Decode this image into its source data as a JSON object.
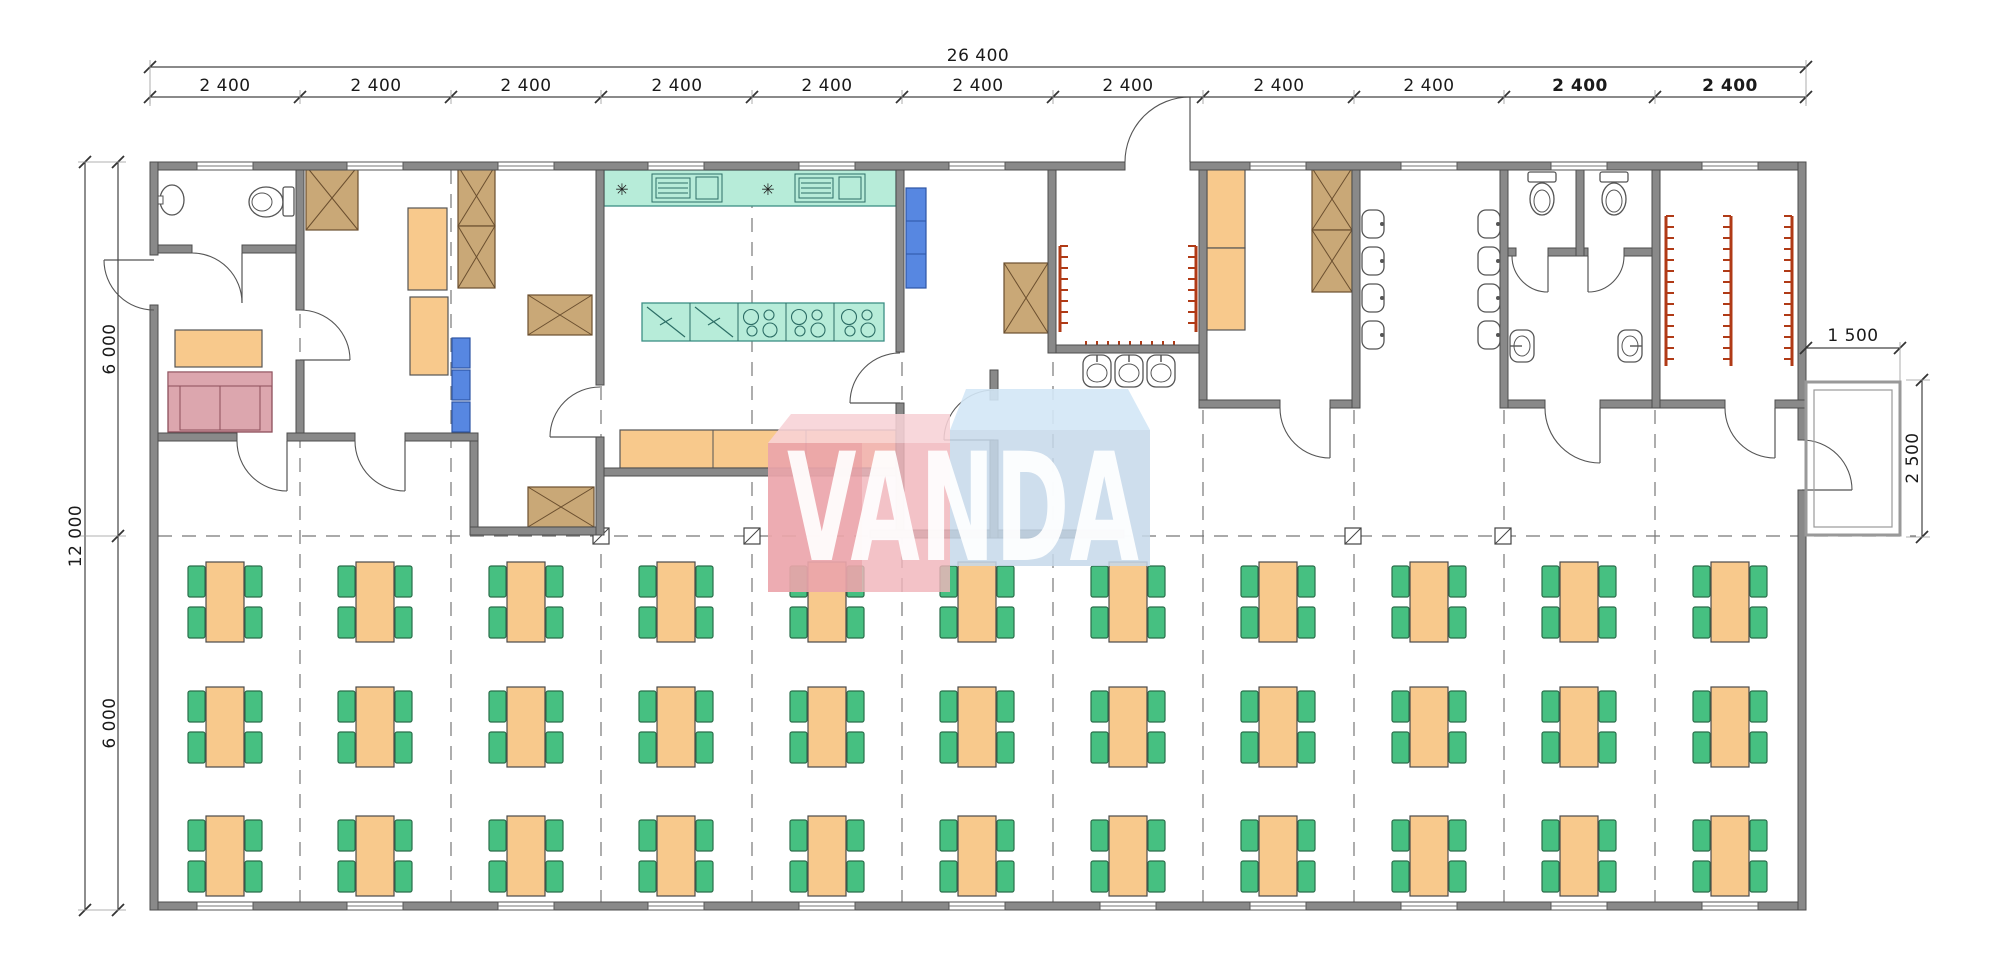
{
  "drawing": {
    "type": "architectural-floor-plan",
    "dimensions": {
      "total_width": "26 400",
      "modules": [
        "2 400",
        "2 400",
        "2 400",
        "2 400",
        "2 400",
        "2 400",
        "2 400",
        "2 400",
        "2 400",
        "2 400",
        "2 400"
      ],
      "total_height": "12 000",
      "height_halves": [
        "6 000",
        "6 000"
      ],
      "porch_width": "1 500",
      "porch_depth": "2 500"
    },
    "watermark": {
      "text": "VANDA",
      "pink": "#f0b4bb",
      "blue": "#c6d8ea"
    },
    "dining": {
      "table_columns": 11,
      "table_rows": 3,
      "tables_total": 33,
      "chairs_per_table": 4
    },
    "icons": {
      "dining-table": "rectangular dining table",
      "chair": "dining chair",
      "wardrobe-x-icon": "crossed wardrobe / cabinet",
      "cabinet": "orange cabinet / locker",
      "shelf-blue": "blue shelf unit",
      "sofa-icon": "two-seat sofa",
      "toilet-icon": "toilet",
      "washbasin-icon": "washbasin",
      "urinal-icon": "urinal",
      "sink-counter-icon": "kitchen counter with sink and drainboard",
      "cooktop-icon": "stove cooktop with burners",
      "fridge-icon": "refrigerator cell",
      "burner-star-icon": "appliance symbol",
      "coat-rack-icon": "coat hook rack",
      "column-icon": "structural column",
      "door-swing-icon": "door with swing arc",
      "window-icon": "window in wall",
      "porch": "entrance porch"
    },
    "colors": {
      "wall": "#898989",
      "furniture_orange": "#f8c98c",
      "chair_green": "#46c081",
      "kitchen_teal": "#b7ecd9",
      "wood_tan": "#c9a877",
      "shelf_blue": "#5787e1",
      "sofa_pink": "#dca6ae",
      "rack_red": "#b03a16",
      "dimension_text": "#1a1a1a"
    }
  }
}
